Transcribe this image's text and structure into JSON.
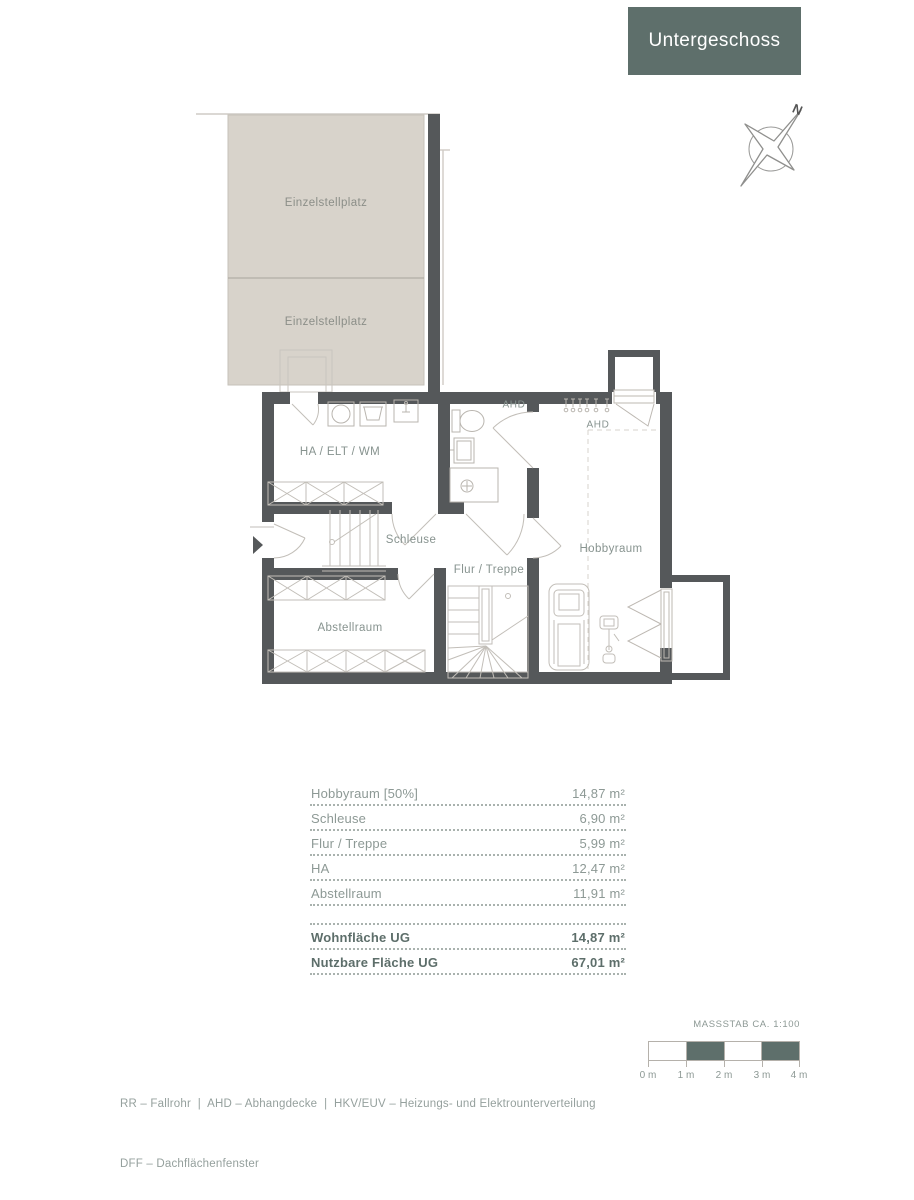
{
  "title": {
    "label": "Untergeschoss"
  },
  "compass": {
    "north_label": "N"
  },
  "plan": {
    "labels": {
      "parking_upper": "Einzelstellplatz",
      "parking_lower": "Einzelstellplatz",
      "ha_elt_wm": "HA / ELT / WM",
      "schleuse": "Schleuse",
      "flur_treppe": "Flur / Treppe",
      "hobbyraum": "Hobbyraum",
      "abstellraum": "Abstellraum",
      "ahd_1": "AHD",
      "ahd_2": "AHD"
    }
  },
  "area_table": {
    "rows": [
      {
        "label": "Hobbyraum [50%]",
        "value": "14,87 m²"
      },
      {
        "label": "Schleuse",
        "value": "6,90 m²"
      },
      {
        "label": "Flur / Treppe",
        "value": "5,99 m²"
      },
      {
        "label": "HA",
        "value": "12,47 m²"
      },
      {
        "label": "Abstellraum",
        "value": "11,91 m²"
      }
    ],
    "totals": [
      {
        "label": "Wohnfläche UG",
        "value": "14,87 m²"
      },
      {
        "label": "Nutzbare Fläche UG",
        "value": "67,01 m²"
      }
    ]
  },
  "scale": {
    "caption": "MASSSTAB CA. 1:100",
    "tick_labels": [
      "0 m",
      "1 m",
      "2 m",
      "3 m",
      "4 m"
    ]
  },
  "legend": {
    "line1": "RR – Fallrohr  |  AHD – Abhangdecke  |  HKV/EUV – Heizungs- und Elektrounterverteilung",
    "line2": "DFF – Dachflächenfenster"
  },
  "colors": {
    "accent": "#5e6f6b",
    "wall": "#55585a",
    "parking_fill": "#d8d3cb",
    "label_text": "#87938f"
  }
}
